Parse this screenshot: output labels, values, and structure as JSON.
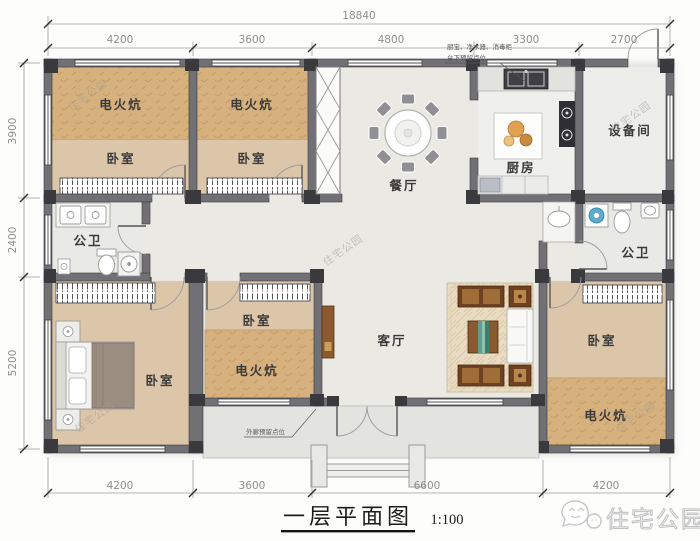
{
  "dimensions": {
    "overall_top": "18840",
    "top": [
      "4200",
      "3600",
      "4800",
      "3300",
      "2700"
    ],
    "left": [
      "3900",
      "2400",
      "5200"
    ],
    "bottom": [
      "4200",
      "3600",
      "6600",
      "4200"
    ]
  },
  "rooms": {
    "kang_top_left": "电火炕",
    "bedroom_top_left": "卧室",
    "kang_top_mid": "电火炕",
    "bedroom_top_mid": "卧室",
    "dining": "餐厅",
    "kitchen": "厨房",
    "utility": "设备间",
    "bath_left": "公卫",
    "bath_right": "公卫",
    "bedroom_center": "卧室",
    "kang_center": "电火炕",
    "bedroom_left": "卧室",
    "living": "客厅",
    "bedroom_right": "卧室",
    "kang_right": "电火炕"
  },
  "annotations": {
    "kitchen_note_line1": "厨宝、净水器、消毒柜",
    "kitchen_note_line2": "台下预留点位",
    "porch_note": "外廊预留点位"
  },
  "title": {
    "text": "一层平面图",
    "scale": "1:100"
  },
  "watermark": {
    "diagonal": "住宅公园",
    "brand": "住宅公园"
  },
  "colors": {
    "wall": "#717175",
    "column": "#3a3a3e",
    "kang": "#d6b17e",
    "bedroom_floor": "#dcc6aa",
    "common_floor": "#eae9e4",
    "wood": "#8a5a2e"
  }
}
